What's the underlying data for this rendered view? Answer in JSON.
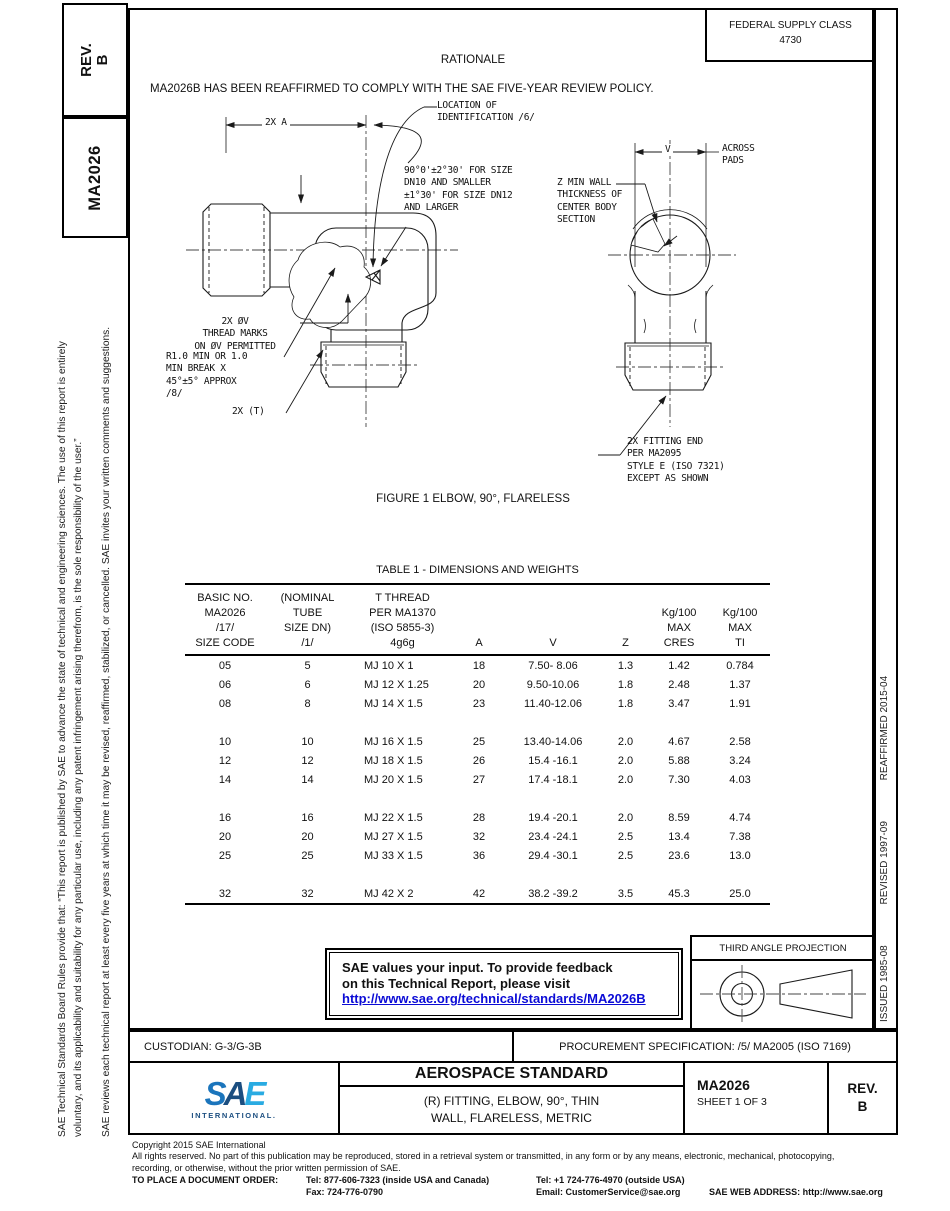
{
  "doc": {
    "rev_line1": "REV.",
    "rev_line2": "B",
    "number": "MA2026"
  },
  "header": {
    "fsc_line1": "FEDERAL SUPPLY CLASS",
    "fsc_line2": "4730",
    "rationale_title": "RATIONALE",
    "rationale_text": "MA2026B HAS BEEN REAFFIRMED TO COMPLY WITH THE SAE FIVE-YEAR REVIEW POLICY."
  },
  "left_sidebar": {
    "para1": "SAE Technical Standards Board Rules provide that: “This report is published by SAE to advance the state of technical and engineering sciences. The use of this report is entirely\nvoluntary, and its applicability and suitability for any particular use, including any patent infringement arising therefrom, is the sole responsibility of the user.”",
    "para2": "SAE reviews each technical report at least every five years at which time it may be revised, reaffirmed, stabilized, or cancelled. SAE invites your written comments and suggestions."
  },
  "right_sidebar": {
    "issued": "ISSUED 1985-08",
    "revised": "REVISED 1997-09",
    "reaffirmed": "REAFFIRMED 2015-04"
  },
  "figure": {
    "caption": "FIGURE 1 ELBOW, 90°, FLARELESS",
    "annotations": {
      "dim_a": "2X A",
      "location_id": "LOCATION OF\nIDENTIFICATION /6/",
      "angle_note": "90°0'±2°30' FOR SIZE\nDN10 AND SMALLER\n±1°30' FOR SIZE DN12\nAND LARGER",
      "z_wall": "Z MIN WALL\nTHICKNESS OF\nCENTER BODY\nSECTION",
      "v_label": "V",
      "across_pads": "ACROSS\nPADS",
      "thread_marks": "2X ØV\nTHREAD MARKS\nON ØV PERMITTED",
      "break_note": "R1.0 MIN OR 1.0\nMIN BREAK X\n45°±5° APPROX\n/8/",
      "t_note": "2X (T)",
      "fitting_end": "2X FITTING END\nPER MA2095\nSTYLE E (ISO 7321)\nEXCEPT AS SHOWN"
    }
  },
  "table": {
    "title": "TABLE 1 - DIMENSIONS AND WEIGHTS",
    "col_headers": [
      "BASIC NO.\nMA2026\n/17/\nSIZE CODE",
      "(NOMINAL\nTUBE\nSIZE DN)\n/1/",
      "T THREAD\nPER MA1370\n(ISO 5855-3)\n4g6g",
      "A",
      "V",
      "Z",
      "Kg/100\nMAX\nCRES",
      "Kg/100\nMAX\nTI"
    ],
    "groups": [
      [
        [
          "05",
          "5",
          "MJ 10 X 1",
          "18",
          "7.50- 8.06",
          "1.3",
          "1.42",
          "0.784"
        ],
        [
          "06",
          "6",
          "MJ 12 X 1.25",
          "20",
          "9.50-10.06",
          "1.8",
          "2.48",
          "1.37"
        ],
        [
          "08",
          "8",
          "MJ 14 X 1.5",
          "23",
          "11.40-12.06",
          "1.8",
          "3.47",
          "1.91"
        ]
      ],
      [
        [
          "10",
          "10",
          "MJ 16 X 1.5",
          "25",
          "13.40-14.06",
          "2.0",
          "4.67",
          "2.58"
        ],
        [
          "12",
          "12",
          "MJ 18 X 1.5",
          "26",
          "15.4 -16.1",
          "2.0",
          "5.88",
          "3.24"
        ],
        [
          "14",
          "14",
          "MJ 20 X 1.5",
          "27",
          "17.4 -18.1",
          "2.0",
          "7.30",
          "4.03"
        ]
      ],
      [
        [
          "16",
          "16",
          "MJ 22 X 1.5",
          "28",
          "19.4 -20.1",
          "2.0",
          "8.59",
          "4.74"
        ],
        [
          "20",
          "20",
          "MJ 27 X 1.5",
          "32",
          "23.4 -24.1",
          "2.5",
          "13.4",
          "7.38"
        ],
        [
          "25",
          "25",
          "MJ 33 X 1.5",
          "36",
          "29.4 -30.1",
          "2.5",
          "23.6",
          "13.0"
        ]
      ],
      [
        [
          "32",
          "32",
          "MJ 42 X 2",
          "42",
          "38.2 -39.2",
          "3.5",
          "45.3",
          "25.0"
        ]
      ]
    ]
  },
  "feedback_box": {
    "line1": "SAE values your input. To provide feedback",
    "line2": "on this Technical Report, please visit",
    "link": "http://www.sae.org/technical/standards/MA2026B"
  },
  "projection_box": {
    "label": "THIRD ANGLE PROJECTION"
  },
  "custodian_row": {
    "custodian": "CUSTODIAN: G-3/G-3B",
    "procurement": "PROCUREMENT SPECIFICATION: /5/ MA2005 (ISO 7169)"
  },
  "title_block": {
    "logo_letters": [
      "S",
      "A",
      "E"
    ],
    "logo_sub": "INTERNATIONAL.",
    "doc_type": "AEROSPACE STANDARD",
    "title_line1": "(R) FITTING, ELBOW, 90°, THIN",
    "title_line2": "WALL, FLARELESS, METRIC",
    "doc_number": "MA2026",
    "sheet": "SHEET 1 OF 3",
    "rev_label": "REV.",
    "rev_value": "B"
  },
  "footer": {
    "copyright": "Copyright 2015 SAE International",
    "rights1": "All rights reserved. No part of this publication may be reproduced, stored in a retrieval system or transmitted, in any form or by any means, electronic, mechanical, photocopying,",
    "rights2": "recording, or otherwise, without the prior written permission of SAE.",
    "order_label": "TO PLACE A DOCUMENT ORDER:",
    "tel_inside": "Tel: 877-606-7323 (inside USA and Canada)",
    "tel_outside": "Tel: +1 724-776-4970 (outside USA)",
    "fax": "Fax: 724-776-0790",
    "email": "Email: CustomerService@sae.org",
    "web": "SAE WEB ADDRESS: http://www.sae.org"
  },
  "colors": {
    "link_blue": "#0b0bd6",
    "sae_blue": "#1b75bc",
    "sae_dark_blue": "#1b4e80",
    "sae_light_blue": "#29abe2"
  }
}
